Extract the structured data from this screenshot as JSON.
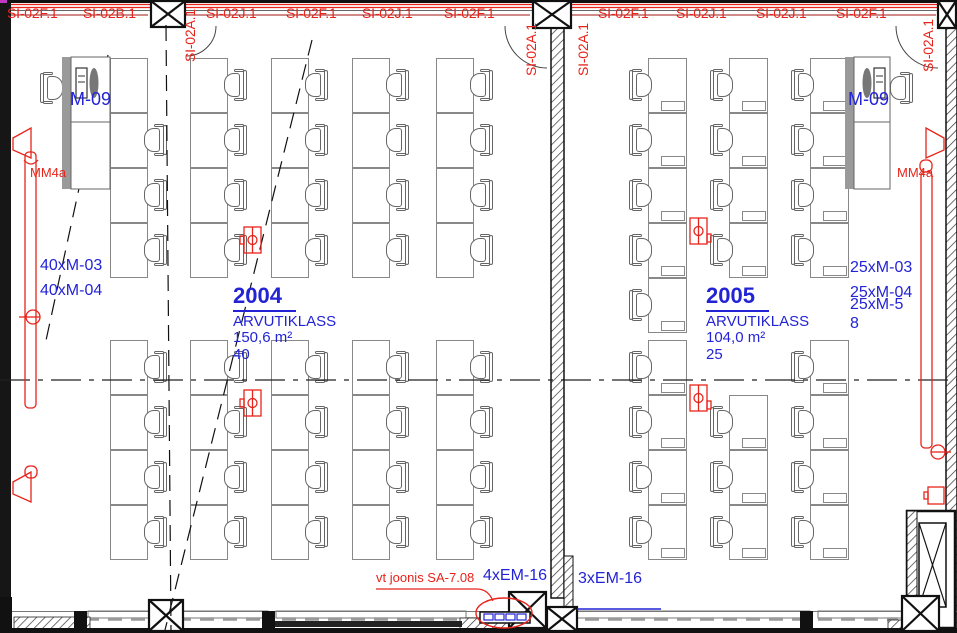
{
  "colors": {
    "red": "#e8231a",
    "blue": "#2323d6",
    "line_gray": "#888",
    "wall_dark": "#151515",
    "magenta": "#c238c2"
  },
  "top_labels": [
    {
      "text": "SI-02F.1",
      "x": 7,
      "y": 6
    },
    {
      "text": "SI-02B.1",
      "x": 83,
      "y": 6
    },
    {
      "text": "SI-02A.1",
      "x": 183,
      "y": 62,
      "vertical": true
    },
    {
      "text": "SI-02J.1",
      "x": 206,
      "y": 6
    },
    {
      "text": "SI-02F.1",
      "x": 286,
      "y": 6
    },
    {
      "text": "SI-02J.1",
      "x": 362,
      "y": 6
    },
    {
      "text": "SI-02F.1",
      "x": 444,
      "y": 6
    },
    {
      "text": "SI-02A.1",
      "x": 524,
      "y": 76,
      "vertical": true
    },
    {
      "text": "SI-02A.1",
      "x": 576,
      "y": 76,
      "vertical": true
    },
    {
      "text": "SI-02F.1",
      "x": 598,
      "y": 6
    },
    {
      "text": "SI-02J.1",
      "x": 676,
      "y": 6
    },
    {
      "text": "SI-02J.1",
      "x": 756,
      "y": 6
    },
    {
      "text": "SI-02F.1",
      "x": 836,
      "y": 6
    },
    {
      "text": "SI-02A.1",
      "x": 921,
      "y": 72,
      "vertical": true
    }
  ],
  "rooms": [
    {
      "number": "2004",
      "name": "ARVUTIKLASS",
      "area": "150,6 m²",
      "count": "40"
    },
    {
      "number": "2005",
      "name": "ARVUTIKLASS",
      "area": "104,0 m²",
      "count": "25"
    }
  ],
  "blue_labels": [
    {
      "text": "M-09",
      "x": 70,
      "y": 90,
      "size": 18
    },
    {
      "text": "M-09",
      "x": 848,
      "y": 90,
      "size": 18
    },
    {
      "text": "40xM-03",
      "x": 40,
      "y": 258,
      "size": 16
    },
    {
      "text": "40xM-04",
      "x": 40,
      "y": 283,
      "size": 16
    },
    {
      "text": "25xM-03",
      "x": 850,
      "y": 260,
      "size": 16
    },
    {
      "text": "25xM-04",
      "x": 850,
      "y": 285,
      "size": 16
    },
    {
      "text": "25xM-5",
      "x": 850,
      "y": 297,
      "size": 16
    },
    {
      "text": "8",
      "x": 850,
      "y": 316,
      "size": 16
    },
    {
      "text": "4xEM-16",
      "x": 483,
      "y": 568,
      "size": 16
    },
    {
      "text": "3xEM-16",
      "x": 578,
      "y": 571,
      "size": 16
    }
  ],
  "red_labels": [
    {
      "text": "MM4a",
      "x": 30,
      "y": 166,
      "size": 13
    },
    {
      "text": "MM4a",
      "x": 897,
      "y": 166,
      "size": 13
    },
    {
      "text": "vt joonis SA-7.08",
      "x": 376,
      "y": 571,
      "size": 13
    }
  ],
  "furniture": {
    "desk_2004": {
      "desk_w": 38,
      "row_h": 55,
      "chair_side": "right",
      "columns": [
        {
          "x": 110,
          "rows": [
            113,
            168,
            223,
            340,
            395,
            450,
            505
          ]
        },
        {
          "x": 190,
          "rows": [
            58,
            113,
            168,
            223,
            340,
            395,
            450,
            505
          ]
        },
        {
          "x": 271,
          "rows": [
            58,
            113,
            168,
            223,
            340,
            395,
            450,
            505
          ]
        },
        {
          "x": 352,
          "rows": [
            58,
            113,
            168,
            223,
            340,
            395,
            450,
            505
          ]
        },
        {
          "x": 436,
          "rows": [
            58,
            113,
            168,
            223,
            340,
            395,
            450,
            505
          ]
        }
      ],
      "extra_desks": [
        {
          "x": 110,
          "y": 58
        }
      ]
    },
    "desk_2005": {
      "desk_w": 39,
      "row_h": 55,
      "chair_side": "left",
      "pc": true,
      "columns": [
        {
          "x": 648,
          "rows": [
            58,
            113,
            168,
            223,
            278,
            340,
            395,
            450,
            505
          ]
        },
        {
          "x": 729,
          "rows": [
            58,
            113,
            168,
            223,
            395,
            450,
            505
          ]
        },
        {
          "x": 810,
          "rows": [
            58,
            113,
            168,
            223,
            340,
            395,
            450,
            505
          ]
        }
      ]
    },
    "extra_chairs": [
      {
        "x": 40,
        "y": 72,
        "facing": "right"
      },
      {
        "x": 889,
        "y": 72,
        "facing": "left"
      }
    ]
  }
}
